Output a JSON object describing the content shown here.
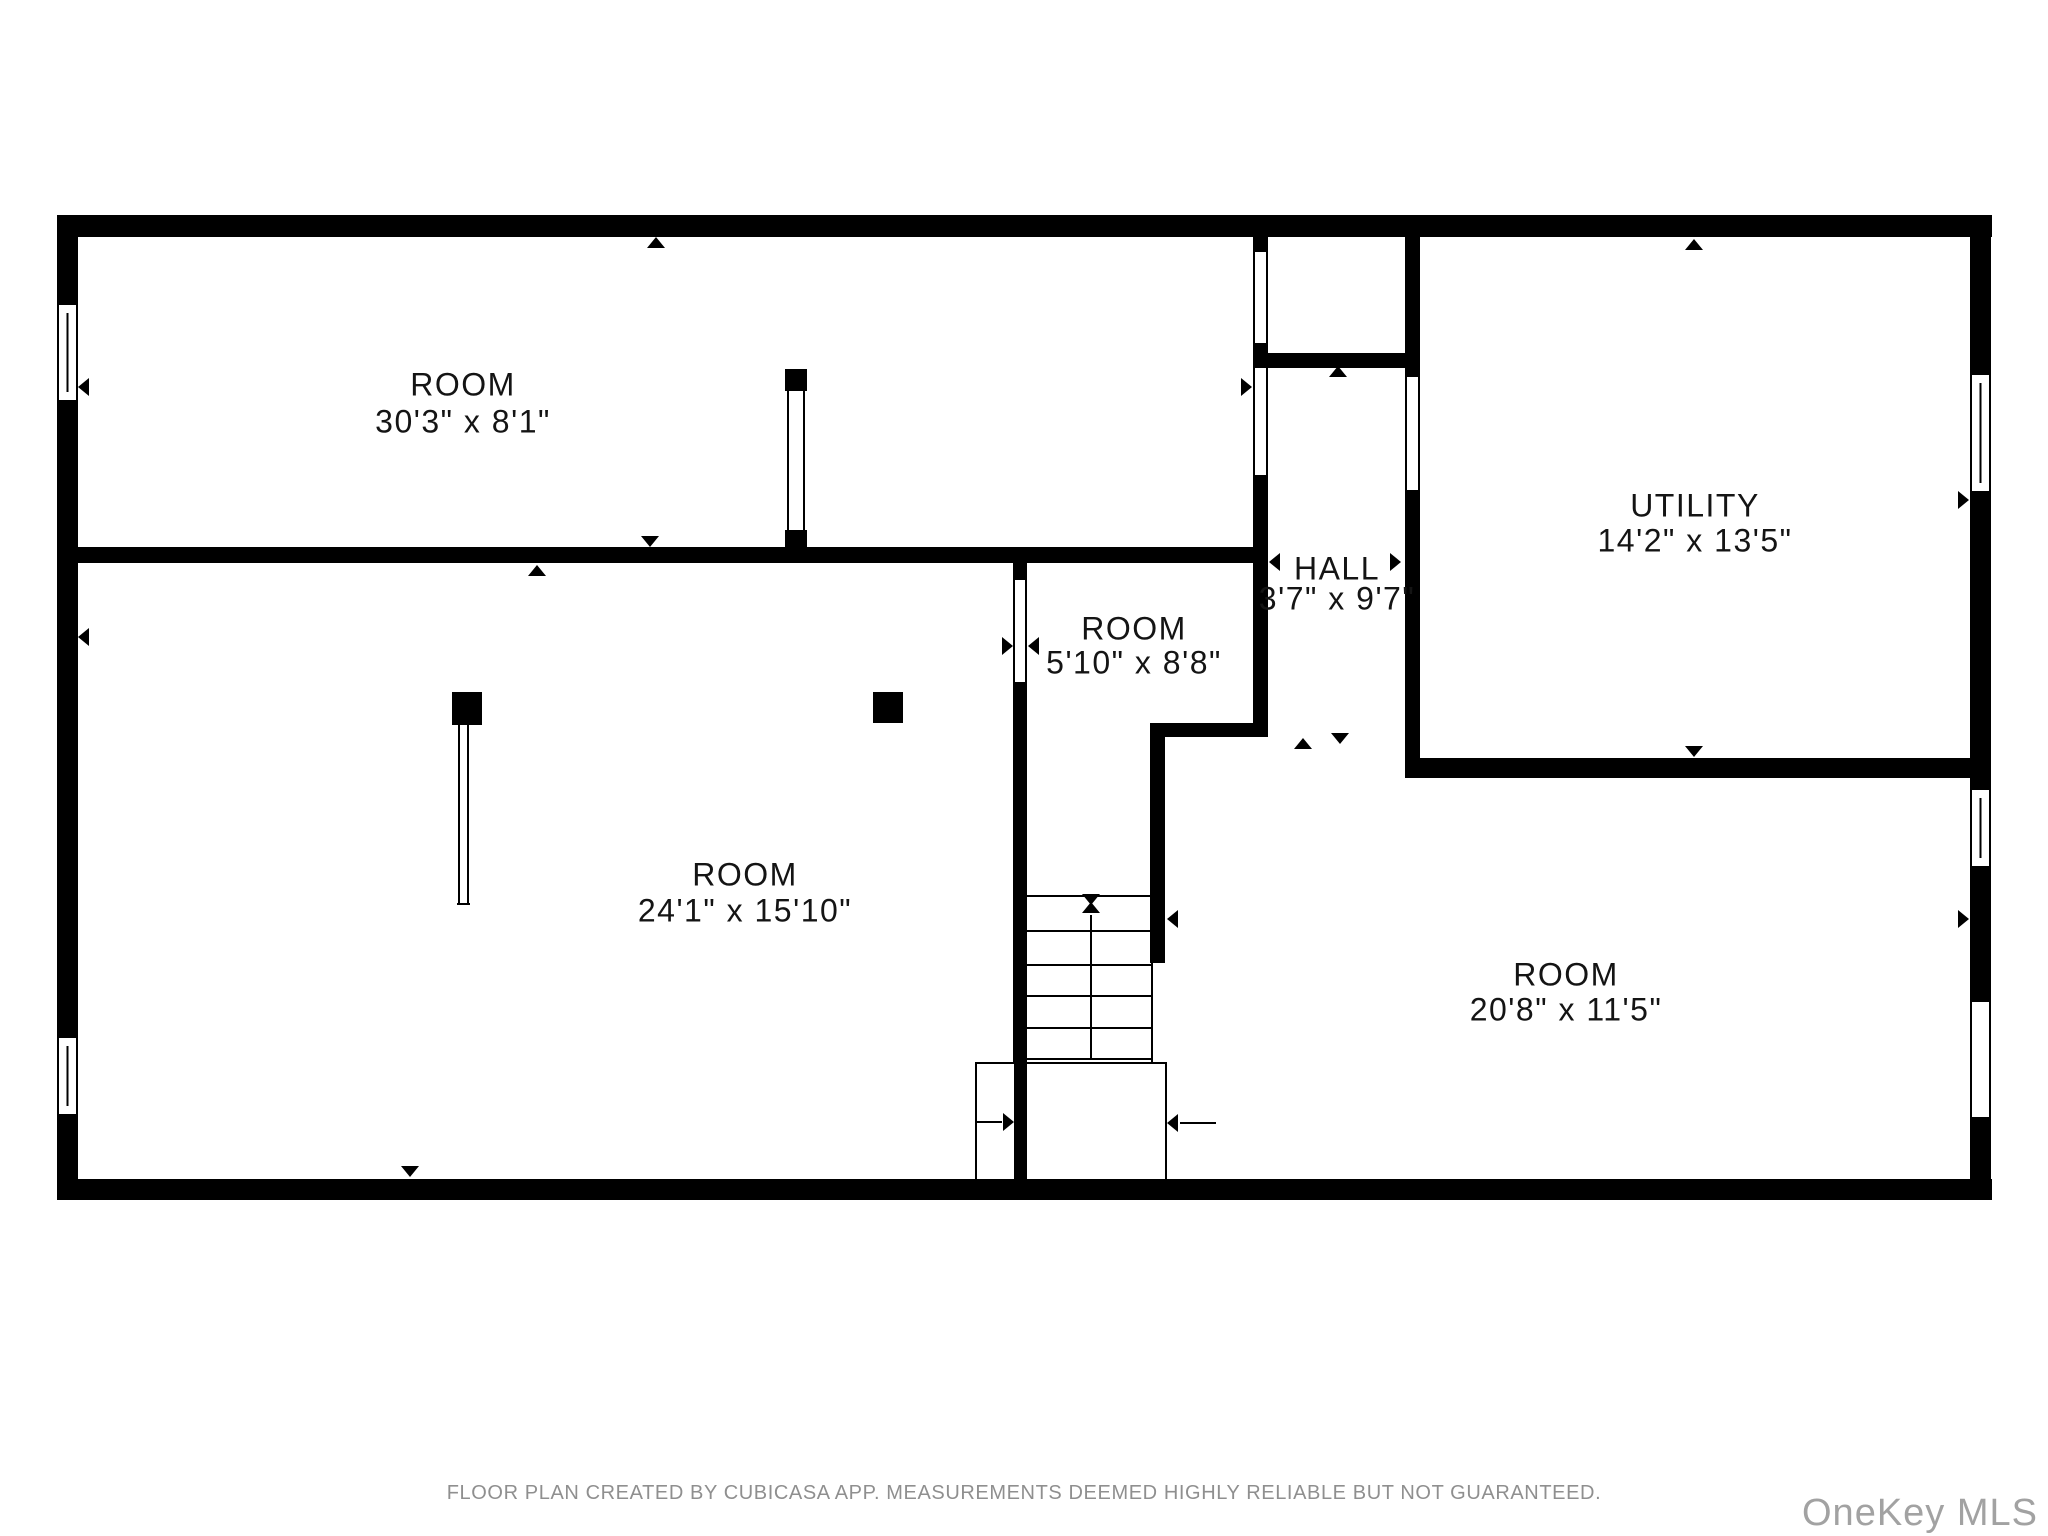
{
  "page": {
    "background": "#ffffff",
    "wall_color": "#000000",
    "label_color": "#141414",
    "footer_color": "#8f8f8f",
    "watermark_color": "#a2a2a2"
  },
  "footer": {
    "disclaimer": "FLOOR PLAN CREATED BY CUBICASA APP. MEASUREMENTS DEEMED HIGHLY RELIABLE BUT NOT GUARANTEED.",
    "watermark": "OneKey MLS"
  },
  "rooms": [
    {
      "id": "room-top",
      "label": "ROOM",
      "dims": "30'3\" x 8'1\"",
      "cx": 463,
      "cy1": 387,
      "cy2": 424
    },
    {
      "id": "room-large",
      "label": "ROOM",
      "dims": "24'1\" x 15'10\"",
      "cx": 745,
      "cy1": 877,
      "cy2": 913
    },
    {
      "id": "room-small",
      "label": "ROOM",
      "dims": "5'10\" x 8'8\"",
      "cx": 1134,
      "cy1": 631,
      "cy2": 665
    },
    {
      "id": "hall",
      "label": "HALL",
      "dims": "3'7\" x 9'7\"",
      "cx": 1337,
      "cy1": 571,
      "cy2": 601
    },
    {
      "id": "utility",
      "label": "UTILITY",
      "dims": "14'2\" x 13'5\"",
      "cx": 1695,
      "cy1": 508,
      "cy2": 543
    },
    {
      "id": "room-right",
      "label": "ROOM",
      "dims": "20'8\" x 11'5\"",
      "cx": 1566,
      "cy1": 977,
      "cy2": 1012
    }
  ],
  "geometry": {
    "walls": [
      [
        57,
        215,
        1935,
        22
      ],
      [
        57,
        215,
        21,
        985
      ],
      [
        1970,
        215,
        21,
        985
      ],
      [
        57,
        1179,
        1935,
        21
      ],
      [
        57,
        547,
        1211,
        16
      ],
      [
        1253,
        233,
        15,
        19
      ],
      [
        1253,
        343,
        15,
        25
      ],
      [
        1253,
        475,
        15,
        248
      ],
      [
        1253,
        353,
        167,
        15
      ],
      [
        1405,
        233,
        15,
        144
      ],
      [
        1405,
        490,
        15,
        268
      ],
      [
        1405,
        758,
        586,
        20
      ],
      [
        1150,
        723,
        118,
        14
      ],
      [
        1150,
        737,
        15,
        226
      ],
      [
        1013,
        563,
        14,
        17
      ],
      [
        1013,
        682,
        14,
        499
      ],
      [
        785,
        369,
        22,
        22
      ],
      [
        785,
        530,
        22,
        22
      ],
      [
        452,
        692,
        30,
        33
      ],
      [
        873,
        692,
        30,
        31
      ]
    ],
    "windows": [
      {
        "x": 57,
        "y": 303,
        "w": 21,
        "h": 99
      },
      {
        "x": 57,
        "y": 1036,
        "w": 21,
        "h": 80
      },
      {
        "x": 1970,
        "y": 373,
        "w": 21,
        "h": 120
      },
      {
        "x": 1970,
        "y": 788,
        "w": 21,
        "h": 80
      }
    ],
    "door_openings": [
      {
        "x": 1970,
        "y": 1002,
        "w": 21,
        "h": 115
      }
    ],
    "thin_lines": [
      [
        788,
        391,
        788,
        530
      ],
      [
        804,
        391,
        804,
        530
      ],
      [
        459,
        725,
        459,
        905
      ],
      [
        468,
        725,
        468,
        905
      ],
      [
        457,
        904,
        470,
        904
      ],
      [
        1152,
        963,
        1152,
        1063
      ],
      [
        1254,
        252,
        1254,
        343
      ],
      [
        1267,
        252,
        1267,
        343
      ],
      [
        1254,
        368,
        1254,
        475
      ],
      [
        1267,
        368,
        1267,
        475
      ],
      [
        1406,
        377,
        1406,
        490
      ],
      [
        1419,
        377,
        1419,
        490
      ],
      [
        1014,
        580,
        1014,
        682
      ],
      [
        1026,
        580,
        1026,
        682
      ],
      [
        1971,
        1002,
        1971,
        1117
      ],
      [
        1990,
        1002,
        1990,
        1117
      ],
      [
        976,
        1122,
        1002,
        1122
      ],
      [
        1180,
        1123,
        1216,
        1123
      ],
      [
        1091,
        915,
        1091,
        1059
      ],
      [
        1027,
        896,
        1151,
        896
      ],
      [
        1027,
        931,
        1151,
        931
      ],
      [
        1027,
        965,
        1151,
        965
      ],
      [
        1027,
        996,
        1151,
        996
      ],
      [
        1027,
        1028,
        1151,
        1028
      ],
      [
        1027,
        1059,
        1151,
        1059
      ]
    ],
    "landing_box": {
      "x": 976,
      "y": 1063,
      "w": 190,
      "h": 117
    },
    "arrows": [
      [
        "u",
        656,
        237
      ],
      [
        "d",
        650,
        547
      ],
      [
        "u",
        537,
        565
      ],
      [
        "l",
        78,
        387
      ],
      [
        "l",
        78,
        637
      ],
      [
        "u",
        1338,
        366
      ],
      [
        "u",
        1303,
        738
      ],
      [
        "d",
        1340,
        744
      ],
      [
        "u",
        1694,
        239
      ],
      [
        "d",
        1694,
        757
      ],
      [
        "r",
        1969,
        500
      ],
      [
        "r",
        1969,
        919
      ],
      [
        "l",
        1167,
        919
      ],
      [
        "r",
        1013,
        646
      ],
      [
        "l",
        1028,
        646
      ],
      [
        "r",
        1252,
        387
      ],
      [
        "l",
        1269,
        562
      ],
      [
        "r",
        1401,
        562
      ],
      [
        "r",
        1014,
        1122
      ],
      [
        "l",
        1167,
        1123
      ],
      [
        "d",
        410,
        1177
      ],
      [
        "d",
        1091,
        905
      ],
      [
        "u",
        1091,
        902
      ]
    ]
  }
}
